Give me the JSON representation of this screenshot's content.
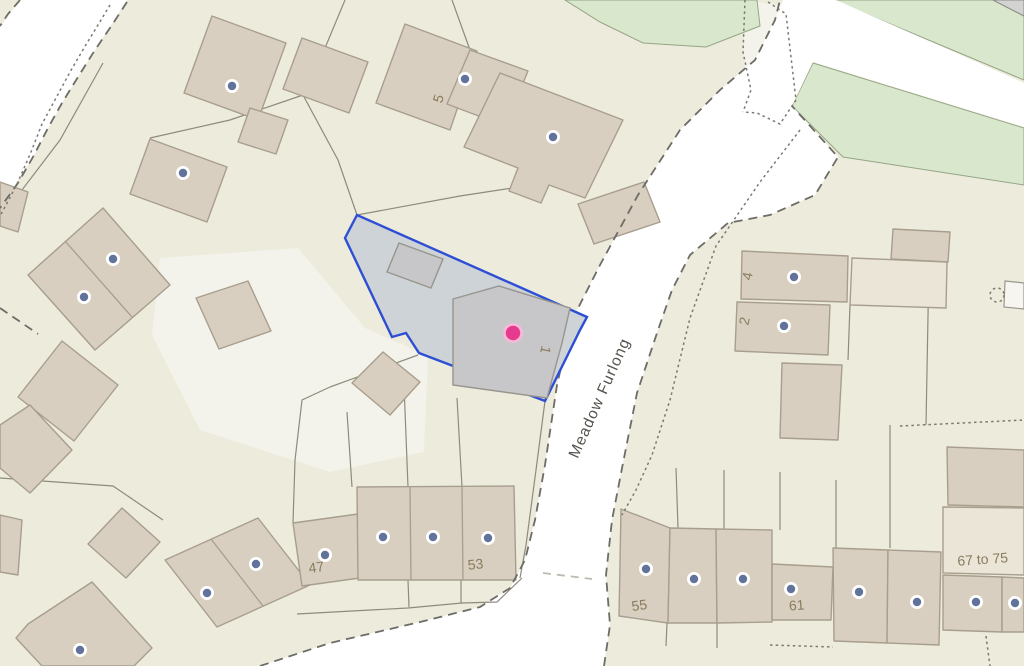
{
  "map": {
    "street_label": "Meadow Furlong",
    "labels": [
      {
        "text": "5",
        "x": 443,
        "y": 100,
        "rot": -72
      },
      {
        "text": "1",
        "x": 541,
        "y": 349,
        "rot": 102
      },
      {
        "text": "4",
        "x": 752,
        "y": 277,
        "rot": -78
      },
      {
        "text": "2",
        "x": 749,
        "y": 322,
        "rot": -78
      },
      {
        "text": "47",
        "x": 317,
        "y": 572,
        "rot": -8
      },
      {
        "text": "53",
        "x": 476,
        "y": 569,
        "rot": -6
      },
      {
        "text": "55",
        "x": 640,
        "y": 610,
        "rot": -8
      },
      {
        "text": "61",
        "x": 797,
        "y": 610,
        "rot": -4
      },
      {
        "text": "67 to 75",
        "x": 983,
        "y": 564,
        "rot": -4
      }
    ],
    "property_markers": [
      {
        "x": 232,
        "y": 86
      },
      {
        "x": 465,
        "y": 79
      },
      {
        "x": 553,
        "y": 137
      },
      {
        "x": 183,
        "y": 173
      },
      {
        "x": 113,
        "y": 259
      },
      {
        "x": 84,
        "y": 297
      },
      {
        "x": 794,
        "y": 277
      },
      {
        "x": 784,
        "y": 326
      },
      {
        "x": 80,
        "y": 650
      },
      {
        "x": 207,
        "y": 593
      },
      {
        "x": 256,
        "y": 564
      },
      {
        "x": 325,
        "y": 555
      },
      {
        "x": 383,
        "y": 537
      },
      {
        "x": 433,
        "y": 537
      },
      {
        "x": 488,
        "y": 538
      },
      {
        "x": 646,
        "y": 569
      },
      {
        "x": 694,
        "y": 579
      },
      {
        "x": 743,
        "y": 579
      },
      {
        "x": 791,
        "y": 589
      },
      {
        "x": 859,
        "y": 592
      },
      {
        "x": 917,
        "y": 602
      },
      {
        "x": 976,
        "y": 602
      },
      {
        "x": 1015,
        "y": 603
      }
    ],
    "selected_marker": {
      "x": 513,
      "y": 333
    },
    "colors": {
      "background": "#edebdc",
      "light_parcel": "#f4f3eb",
      "road": "#ffffff",
      "green_space": "#d9e7cc",
      "gray_area": "#d3d3d1",
      "building": "#d8cfc1",
      "building_outline": "#a89e8e",
      "building_light": "#eae5d7",
      "parcel_line": "#8d8b7c",
      "boundary_dash": "#6d6c66",
      "light_dash": "#bdbbae",
      "path_dots": "#7b7970",
      "highlight_fill": "#cdd3d7",
      "highlight_outline": "#2e4fd3",
      "highlight_building": "#c7c7c9",
      "marker_dot": "#62739b",
      "selected_marker": "#e63a8e",
      "selected_marker_ring": "#f7b9d8",
      "label_text": "#8a7c5c",
      "street_text": "#55554f"
    }
  }
}
